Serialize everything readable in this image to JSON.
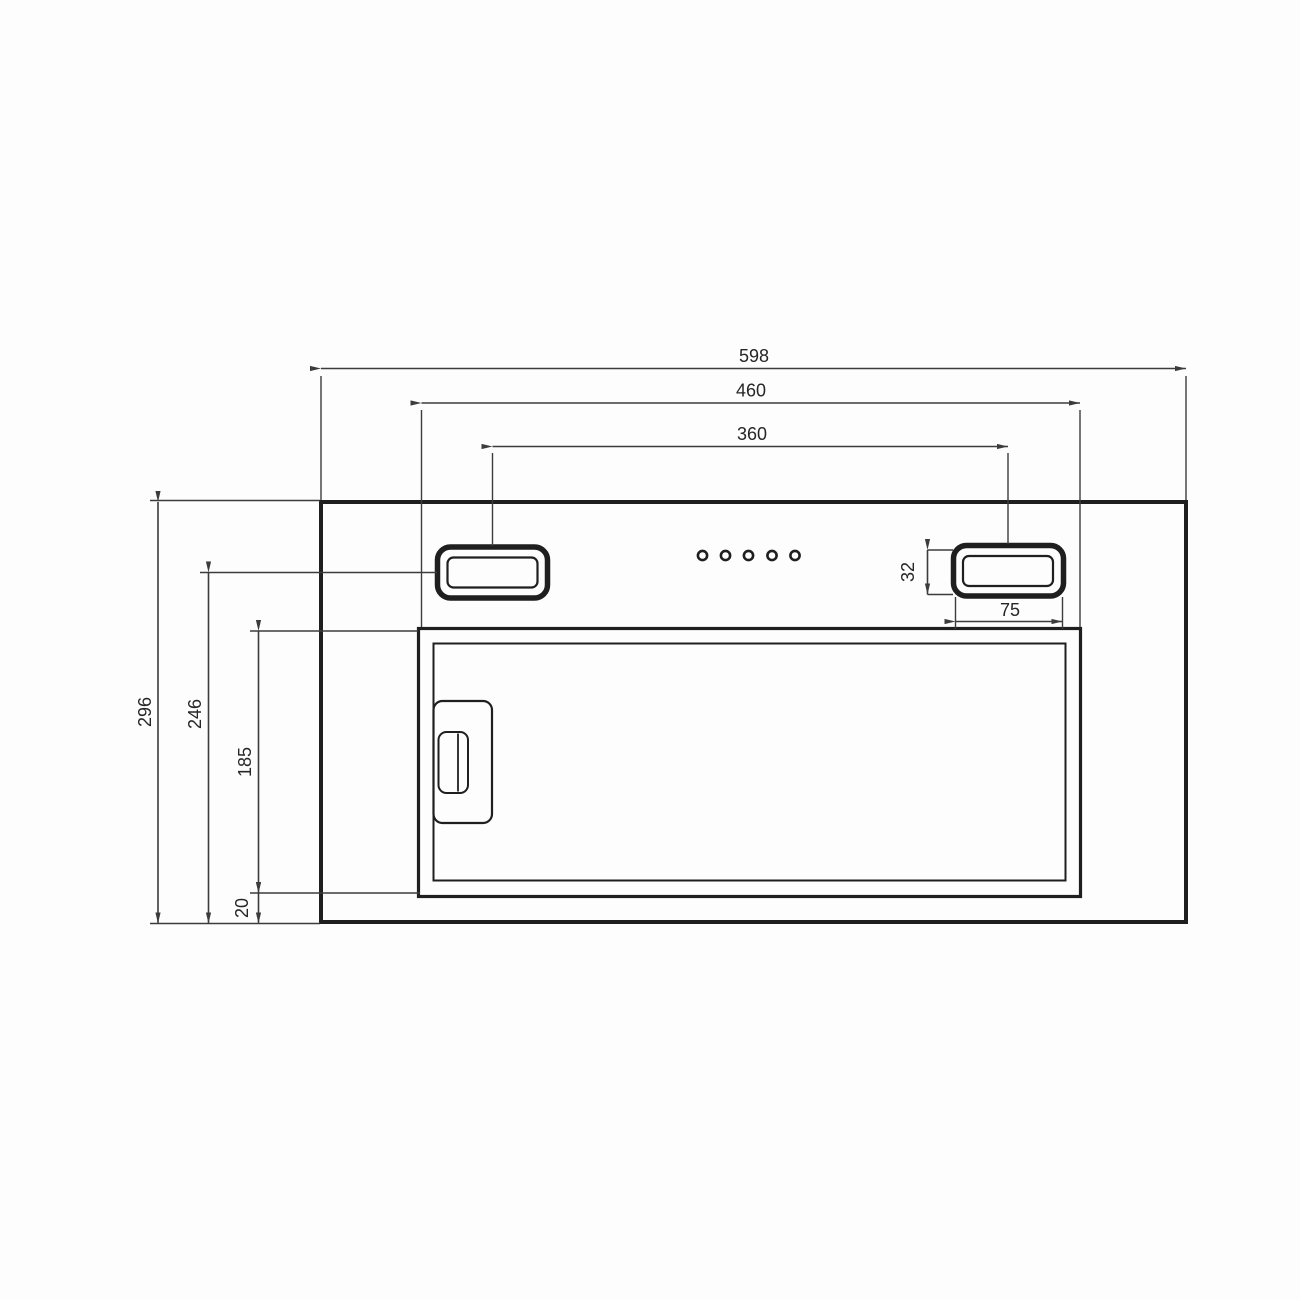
{
  "drawing": {
    "type": "technical-dimension-drawing",
    "subject": "built-in cooker hood front elevation",
    "background": "#fdfdfd",
    "line_color": "#1f1f1f",
    "dim_line_color": "#3c3c3c",
    "text_color": "#262626",
    "control_button_count": 5,
    "dimensions": {
      "overall_width": "598",
      "cutout_width": "460",
      "bracket_spacing": "360",
      "bracket_height": "32",
      "bracket_width": "75",
      "overall_height": "296",
      "bracket_center_from_bottom": "246",
      "panel_height": "185",
      "panel_bottom_offset": "20"
    }
  }
}
